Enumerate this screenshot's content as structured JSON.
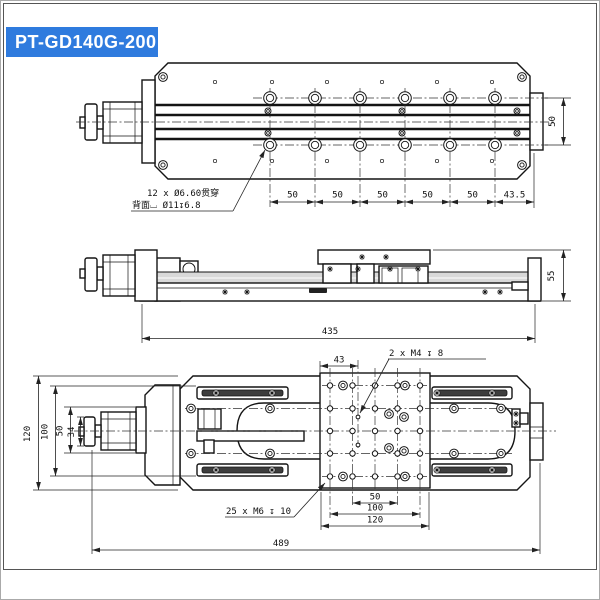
{
  "title": "PT-GD140G-200",
  "colors": {
    "accent": "#2F7BDE",
    "line": "#141414"
  },
  "top_view": {
    "note_line1": "12 x Ø6.60贯穿",
    "note_line2": "背面⌴ Ø11↧6.8",
    "pitch_dims": [
      "50",
      "50",
      "50",
      "50",
      "50",
      "43.5"
    ],
    "side_dim": "50"
  },
  "side_view": {
    "length_dim": "435",
    "height_dim": "55"
  },
  "bottom_view": {
    "offset_dim": "43",
    "note_m4": "2 x M4 ↧ 8",
    "note_m6": "25 x M6 ↧ 10",
    "left_dims": [
      "120",
      "100",
      "50",
      "34"
    ],
    "bottom_dims": [
      "50",
      "100",
      "120"
    ],
    "overall_dim": "489"
  }
}
